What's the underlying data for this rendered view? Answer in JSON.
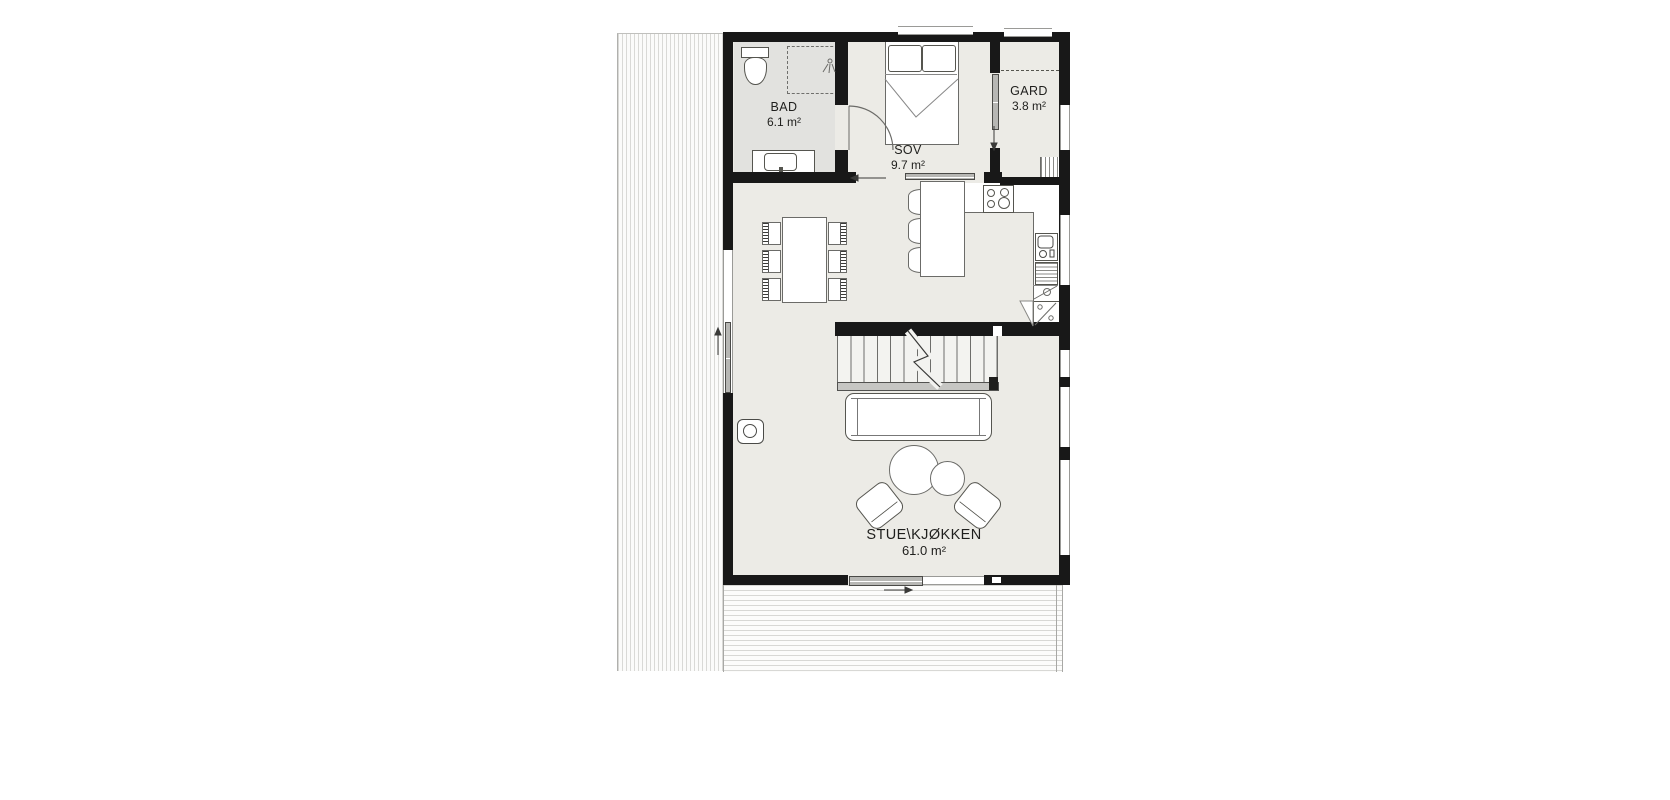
{
  "plan_title": "First floor plan",
  "rooms": {
    "bad": {
      "name": "BAD",
      "area": "6.1 m²"
    },
    "sov": {
      "name": "SOV",
      "area": "9.7 m²"
    },
    "gard": {
      "name": "GARD",
      "area": "3.8 m²"
    },
    "stue_kjokken": {
      "name": "STUE\\KJØKKEN",
      "area": "61.0 m²"
    }
  },
  "colors": {
    "wall": "#181818",
    "floor": "#ecebe6",
    "bathroom_floor": "#e2e2df",
    "furniture_stroke": "#6b6b68",
    "window_line": "#9a9a97",
    "label_text": "#1f1f1d"
  },
  "symbols": [
    "toilet",
    "shower-area",
    "shower-head",
    "bathroom-vanity",
    "double-bed",
    "wardrobe-dashed-front",
    "gard-shelf",
    "cooktop",
    "kitchen-counter",
    "kitchen-sink",
    "dishwasher",
    "refrigerator",
    "kitchen-island",
    "bar-stool",
    "dining-table",
    "dining-chair",
    "staircase",
    "stair-handrail",
    "sofa",
    "coffee-table",
    "armchair",
    "wood-stove",
    "sliding-door",
    "window",
    "deck",
    "roof-overhang"
  ]
}
